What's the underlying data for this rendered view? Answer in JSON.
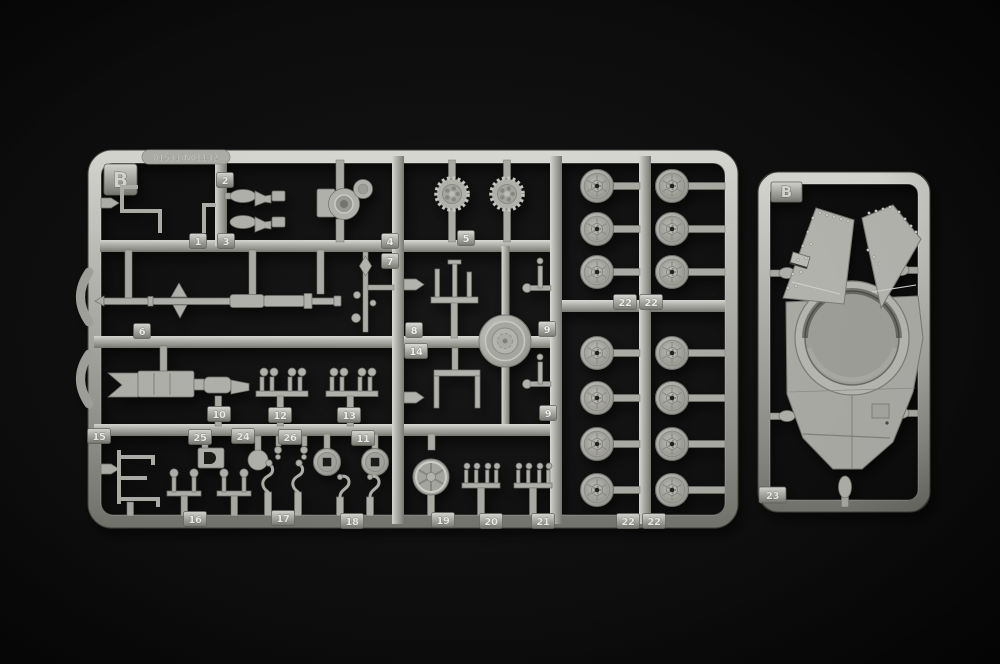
{
  "colors": {
    "background": "#0b0b0b",
    "plastic": "#b5b5b0",
    "plastic_highlight": "#dcdcd7",
    "plastic_shadow": "#787872",
    "tag_text": "#efefec"
  },
  "left_sprue": {
    "letter": "B",
    "embossed_code": "01531/N01132",
    "part_tags": [
      "1",
      "3",
      "2",
      "4",
      "7",
      "5",
      "6",
      "8",
      "14",
      "9",
      "9",
      "10",
      "12",
      "13",
      "15",
      "25",
      "24",
      "26",
      "11",
      "16",
      "17",
      "18",
      "19",
      "20",
      "21",
      "22",
      "22",
      "22",
      "22"
    ]
  },
  "right_sprue": {
    "letter": "B",
    "part_tags": [
      "23"
    ]
  }
}
